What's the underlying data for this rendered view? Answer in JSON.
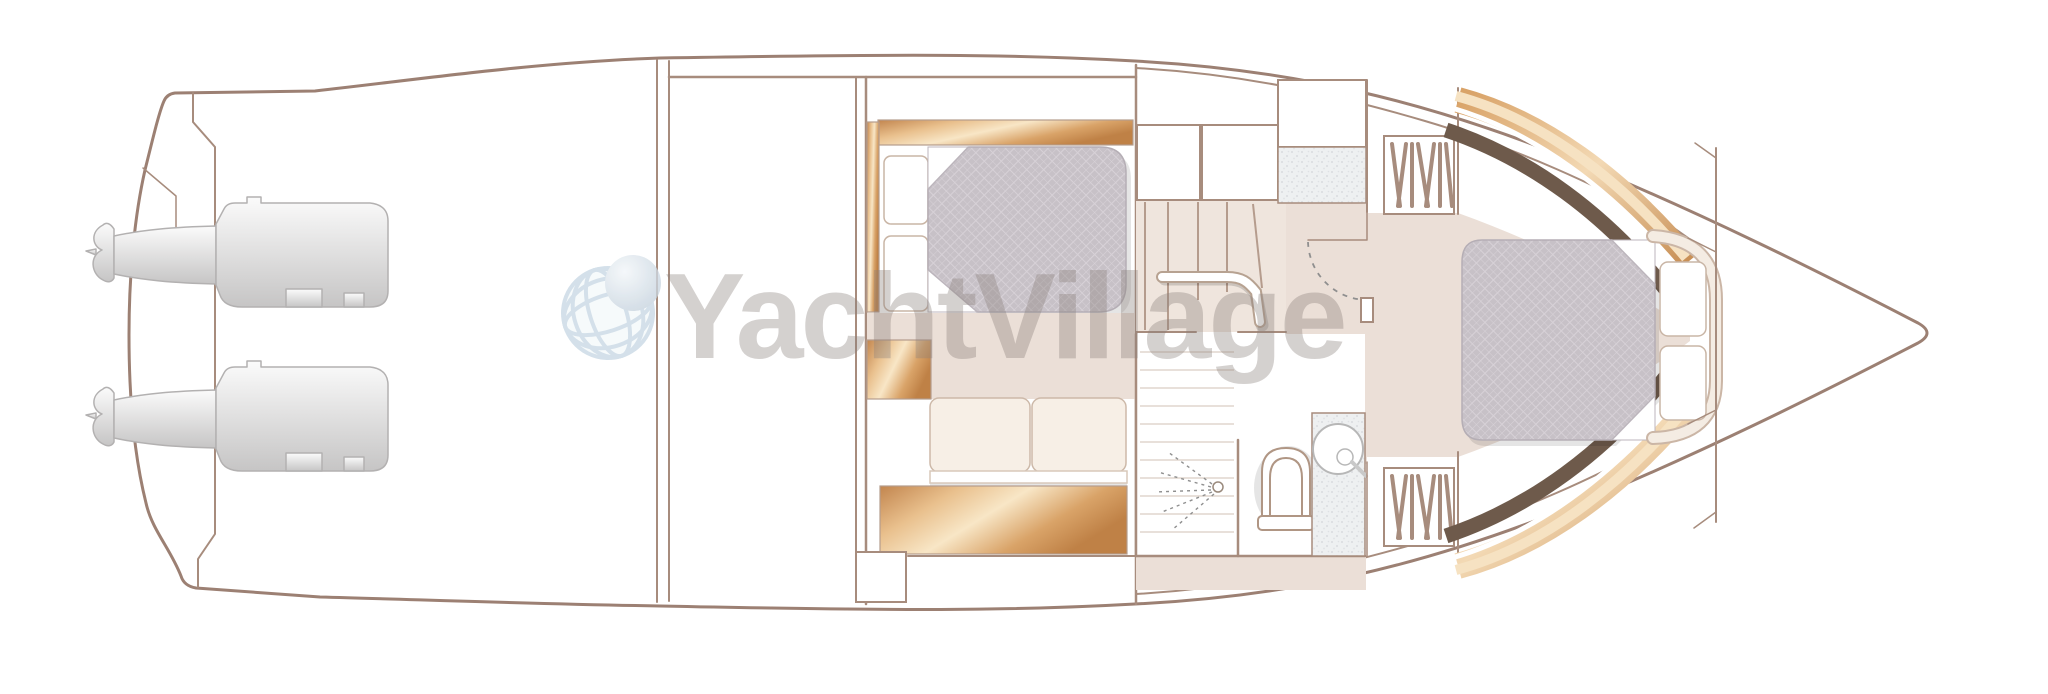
{
  "watermark": {
    "text": "YachtVillage",
    "color": "#8a807c",
    "opacity": 0.4,
    "globe_icon": "globe-icon"
  },
  "palette": {
    "hull_line": "#9c8073",
    "wall_line": "#a78c7d",
    "wall_thin": "#b59c8d",
    "floor_beige": "#ebdfd7",
    "stair_beige": "#efe5dd",
    "wood_light": "#f8e6c6",
    "wood_mid": "#dfa96f",
    "wood_dark": "#bf8146",
    "dark_trim": "#6e5a4b",
    "mattress": "#c7c1c7",
    "mattress_grid": "#d7d1d7",
    "mattress_edge": "#b5aeb5",
    "pillow_edge": "#c9b5a5",
    "cushion": "#f7efe6",
    "cushion_edge": "#cdb9a9",
    "counter_base": "#eef0f1",
    "counter_dot": "#d9dbdf",
    "engine_fill": "#e9e8e8",
    "engine_line": "#b3b1b1",
    "door_arc": "#8f8f8f",
    "watermark_gray": "#8a807c",
    "globe_grid": "#c7d8e4",
    "globe_sphere": "#cdd9e3"
  },
  "icons": [
    {
      "name": "globe-icon"
    },
    {
      "name": "shower-spray-icon"
    },
    {
      "name": "toilet-icon"
    },
    {
      "name": "sink-icon"
    },
    {
      "name": "wardrobe-hanging-icon"
    },
    {
      "name": "stairs-icon"
    },
    {
      "name": "engine-icon"
    }
  ]
}
